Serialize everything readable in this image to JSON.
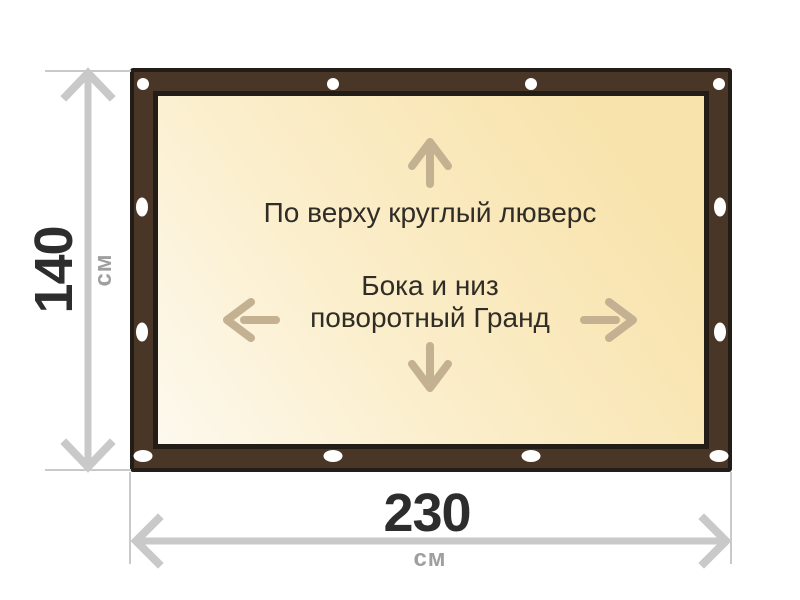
{
  "diagram": {
    "labels": {
      "top_grommet": "По верху круглый люверс",
      "sides_line1": "Бока и низ",
      "sides_line2": "поворотный Гранд"
    },
    "dimensions": {
      "height": {
        "value": "140",
        "unit": "см"
      },
      "width": {
        "value": "230",
        "unit": "см"
      }
    },
    "grommets": {
      "top_shape": "round-circle",
      "side_shape": "vertical-oval",
      "bottom_shape": "horizontal-oval",
      "top_count": 4,
      "bottom_count": 4,
      "left_count": 4,
      "right_count": 4
    },
    "icons": {
      "up_arrow": "up-arrow-icon",
      "down_arrow": "down-arrow-icon",
      "left_arrow": "left-arrow-icon",
      "right_arrow": "right-arrow-icon",
      "height_dimension": "height-dimension-arrow",
      "width_dimension": "width-dimension-arrow"
    },
    "colors": {
      "frame_brown": "#4a3627",
      "frame_outline": "#231d17",
      "canvas_light": "#fdf9ee",
      "canvas_mid": "#fbeecb",
      "canvas_deep": "#f8e3ac",
      "grommet_white": "#ffffff",
      "arrow_tan": "#c3b191",
      "dim_gray": "#c9c9c9",
      "dim_text": "#2d2d2d",
      "unit_gray": "#9f9f9f",
      "label_dark": "#302c26"
    }
  }
}
